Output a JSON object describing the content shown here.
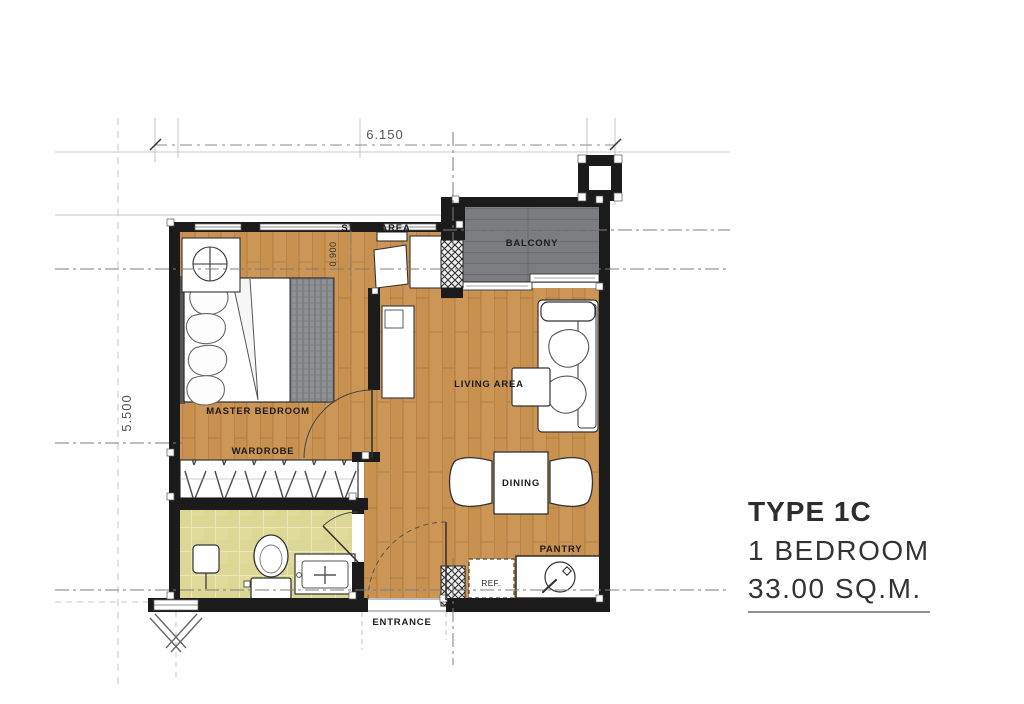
{
  "plan": {
    "dimensions": {
      "top": "6.150",
      "left": "5.500",
      "study": "0.900"
    },
    "rooms": {
      "study": "STUDY AREA",
      "balcony": "BALCONY",
      "master_bedroom": "MASTER BEDROOM",
      "wardrobe": "WARDROBE",
      "living": "LIVING AREA",
      "dining": "DINING",
      "pantry": "PANTRY",
      "ref": "REF.",
      "entrance": "ENTRANCE"
    },
    "colors": {
      "wood_floor": "#c8914f",
      "balcony_floor": "#7b7d80",
      "bathroom_tile": "#dcd794",
      "wall": "#1b1b1b"
    }
  },
  "info": {
    "type": "TYPE 1C",
    "bedrooms": "1 BEDROOM",
    "area": "33.00 SQ.M."
  }
}
